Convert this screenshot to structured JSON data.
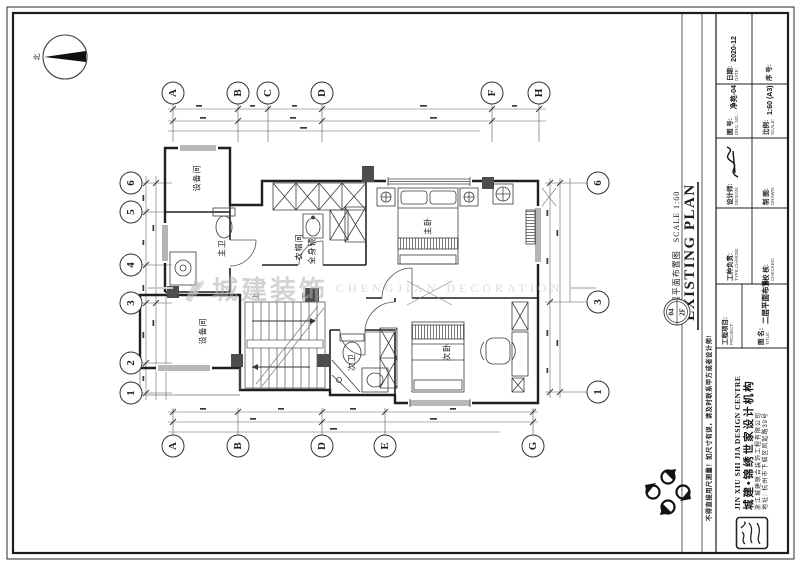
{
  "north": {
    "label": "北"
  },
  "watermark": {
    "zh": "城建装饰",
    "en": "CHENGJIAN DECORATION"
  },
  "grid": {
    "top": [
      "A",
      "B",
      "C",
      "D",
      "F",
      "H"
    ],
    "bottom": [
      "A",
      "B",
      "D",
      "E",
      "G"
    ],
    "left": [
      "6",
      "5",
      "4",
      "3",
      "2",
      "1"
    ],
    "right": [
      "6",
      "3",
      "1"
    ]
  },
  "rooms": {
    "equipment_top": "设备间",
    "master_bath": "主卫",
    "cloakroom": "衣帽间",
    "mirror": "全身镜",
    "master_bedroom": "主卧",
    "equipment_bottom": "设备间",
    "second_bath": "次卫",
    "second_bedroom": "次卧"
  },
  "stairs": {
    "up": "上",
    "down": "下"
  },
  "plan_title": {
    "en": "EXISTING PLAN",
    "zh": "二层平面布置图",
    "scale": "SCALE 1:60",
    "detail_no": "04",
    "floor": "2F"
  },
  "titleblock": {
    "date_label": "日期:",
    "date_label_en": "DATE:",
    "date_value": "2020-12",
    "serial_label": "序 号:",
    "drg_label": "图 号:",
    "drg_label_en": "DRG. NO.:",
    "drg_value": "净苑-04",
    "scale_label": "比例:",
    "scale_label_en": "SCALE:",
    "scale_value": "1:60 (A3)",
    "designer_label": "设计师:",
    "designer_label_en": "DESIGN:",
    "drawn_label": "制 图:",
    "drawn_label_en": "DRAWN:",
    "charge_label": "工种负责:",
    "charge_label_en": "TYPE CHARGE:",
    "checked_label": "校 核:",
    "checked_label_en": "CHECKED:",
    "project_label": "工程项目:",
    "project_label_en": "PROJECT:",
    "title_label": "图 名:",
    "title_label_en": "TITLE:",
    "title_value": "二层平面布置图"
  },
  "company": {
    "name_en": "JIN XIU SHI JIA DESIGN CENTRE",
    "name_zh": "城建•锦绣世家设计机构",
    "line1": "浙江城建联合装饰工程有限公司",
    "line2": "地址: 杭州市下城区凤起路39号"
  },
  "disclaimer": "不得直接用尺测量！如尺寸有误，请及时联系甲方或者设计师!"
}
